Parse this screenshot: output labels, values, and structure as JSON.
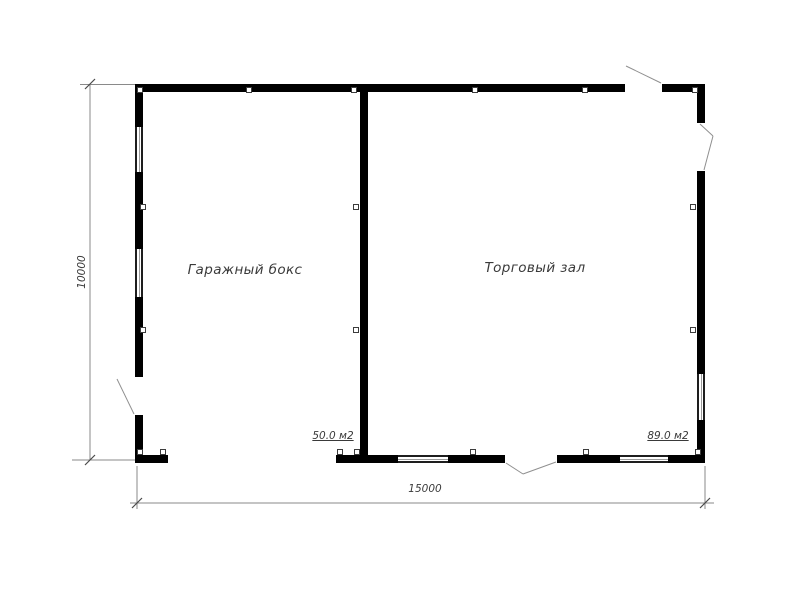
{
  "rooms": [
    {
      "name": "Гаражный бокс",
      "area": "50.0 м2"
    },
    {
      "name": "Торговый зал",
      "area": "89.0 м2"
    }
  ],
  "dimensions": {
    "overall_width": "15000",
    "overall_height": "10000"
  },
  "colors": {
    "wall": "#000000",
    "annotation": "#8a8a8a",
    "text": "#3a3a3a",
    "background": "#ffffff"
  }
}
